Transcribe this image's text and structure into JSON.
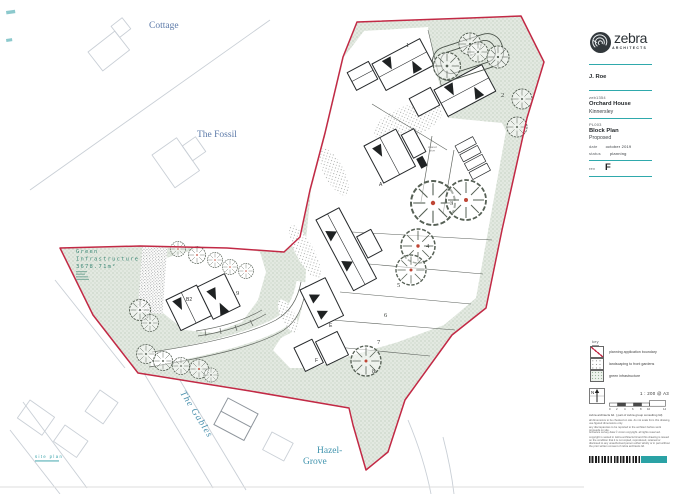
{
  "colors": {
    "boundary_red": "#c22945",
    "green_infrastructure_fill": "#e3e9e1",
    "brand_teal": "#2fa9ac",
    "map_label_blue": "#5b79a8",
    "map_label_teal": "#3f93ad",
    "green_text": "#3f8a78"
  },
  "plan": {
    "labels": {
      "cottage": "Cottage",
      "the_fossil": "The Fossil",
      "the_gables": "The Gables",
      "hazel_line1": "Hazel-",
      "hazel_line2": "Grove",
      "site_plan": "site plan",
      "shared_drive_line1": "shared",
      "shared_drive_line2": "drive",
      "green_infra_line1": "Green",
      "green_infra_line2": "Infrastructure",
      "green_infra_line3": "3678.71m²"
    },
    "plots": [
      "1",
      "2",
      "3",
      "4",
      "5",
      "6",
      "7",
      "8",
      "9"
    ],
    "buildings": {
      "a": "A",
      "b2": "B2",
      "e": "E",
      "f": "F"
    }
  },
  "titleblock": {
    "brand": {
      "name": "zebra",
      "tagline": "ARCHITECTS"
    },
    "client": "J. Roe",
    "project": {
      "number": "zeb1354",
      "name": "Orchard House",
      "location": "Kinnersley"
    },
    "drawing": {
      "number": "PL003",
      "title": "Block Plan",
      "status_line": "Proposed"
    },
    "meta": {
      "date_label": "date",
      "date": "october 2019",
      "status_label": "status",
      "status": "planning",
      "rev_label": "rev",
      "rev": "F"
    },
    "key": {
      "title": "key",
      "items": [
        {
          "label": "planning application boundary"
        },
        {
          "label": "landscaping to front gardens"
        },
        {
          "label": "green infrastructure"
        }
      ]
    },
    "north_label": "N",
    "scale": {
      "text": "1 : 200  @  A3",
      "ticks": [
        "0",
        "2",
        "4",
        "6",
        "8",
        "10",
        "14"
      ]
    },
    "notes": {
      "firm": "zebra architects ltd. ( part of zebra group consulting ltd)",
      "line1": "all dimensions to be checked on site. do not scale from this drawing, use figured dimensions only.",
      "line2": "any discrepancies to be reported to the architect before work proceeds on site.",
      "line3": "ordnance survey data © crown copyright. all rights reserved.",
      "copyright": "copyright is vested in zebra architects ltd and this drawing is issued on the condition that it is not copied, reproduced, retained or disclosed to any unauthorised person either wholly or in part without the prior written consent of zebra architects ltd."
    }
  }
}
